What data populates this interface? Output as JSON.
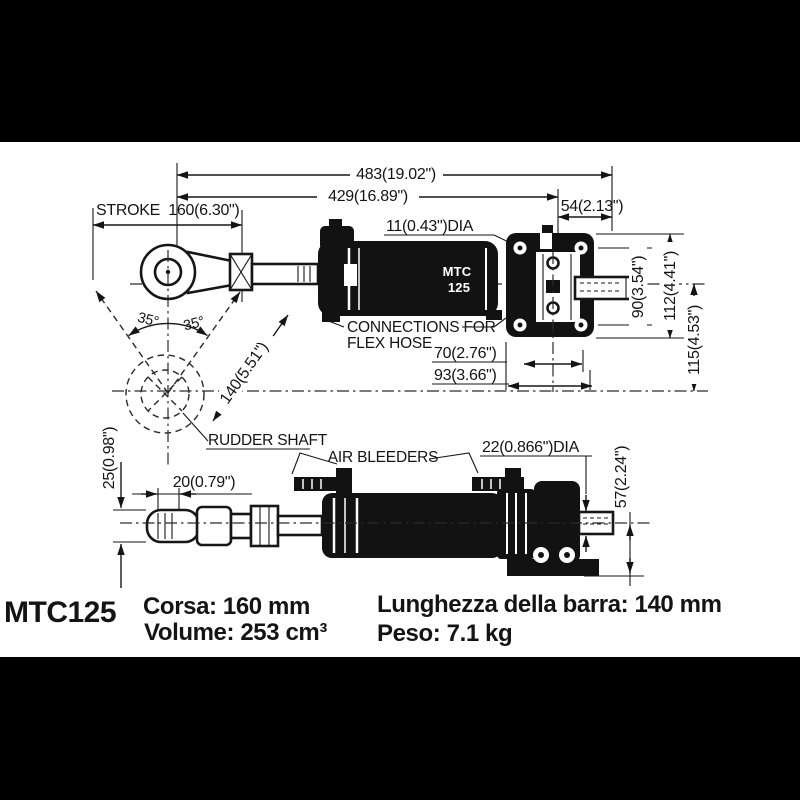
{
  "colors": {
    "ink": "#141414",
    "paper": "#ffffff",
    "band": "#000000"
  },
  "side_view": {
    "dim_overall": "483(19.02\")",
    "dim_to_flange": "429(16.89\")",
    "dim_stroke": "STROKE  160(6.30\")",
    "dim_flange_width": "54(2.13\")",
    "dim_rod_dia": "11(0.43\")DIA",
    "dim_bolt_spacing": "90(3.54\")",
    "dim_flange_height": "112(4.41\")",
    "dim_axis_offset": "115(4.53\")",
    "dim_arm_length": "140(5.51\")",
    "angle_left": "35°",
    "angle_right": "35°",
    "dim_ports_inner": "70(2.76\")",
    "dim_ports_outer": "93(3.66\")",
    "label_connections_line1": "CONNECTIONS FOR",
    "label_connections_line2": "FLEX HOSE",
    "label_rudder_shaft": "RUDDER SHAFT",
    "badge_line1": "MTC",
    "badge_line2": "125"
  },
  "plan_view": {
    "dim_rod_end": "25(0.98\")",
    "dim_thread": "20(0.79\")",
    "label_air_bleeders": "AIR BLEEDERS",
    "dim_shaft_dia": "22(0.866\")DIA",
    "dim_height": "57(2.24\")"
  },
  "footer": {
    "model": "MTC125",
    "corsa": "Corsa: 160 mm",
    "volume": "Volume: 253 cm³",
    "lunghezza": "Lunghezza della barra: 140 mm",
    "peso": "Peso: 7.1 kg"
  }
}
